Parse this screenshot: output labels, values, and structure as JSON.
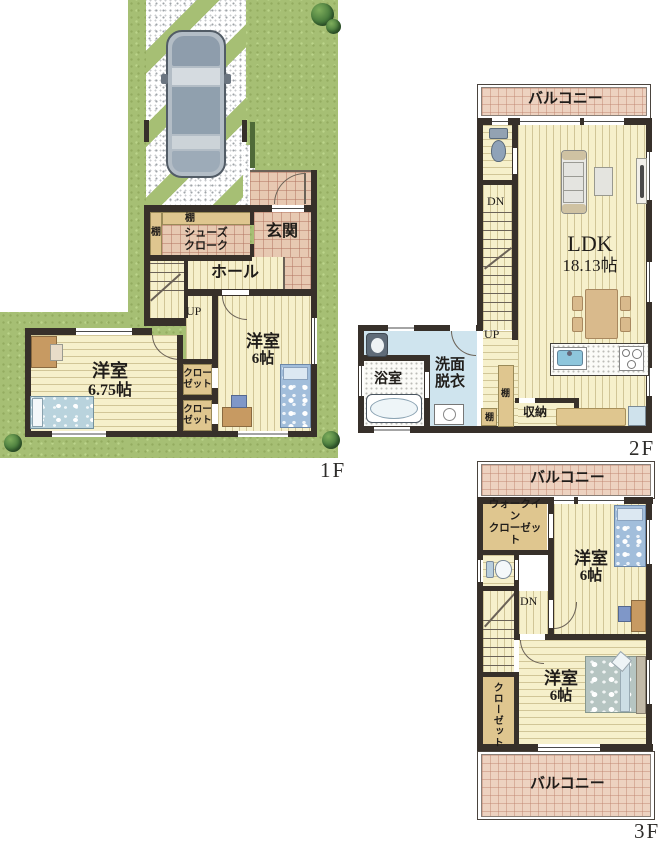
{
  "floors": {
    "f1": {
      "label": "1F",
      "shelf_top": "棚",
      "shelf_left": "棚",
      "shoes_l1": "シューズ",
      "shoes_l2": "クローク",
      "genkan": "玄関",
      "hall": "ホール",
      "up": "UP",
      "room_a_name": "洋室",
      "room_a_size": "6.75帖",
      "room_b_name": "洋室",
      "room_b_size": "6帖",
      "closet_l1": "クロー",
      "closet_l2": "ゼット"
    },
    "f2": {
      "label": "2F",
      "balcony": "バルコニー",
      "dn": "DN",
      "up": "UP",
      "ldk_name": "LDK",
      "ldk_size": "18.13帖",
      "wash_l1": "洗面",
      "wash_l2": "脱衣",
      "bath": "浴室",
      "shelf_a": "棚",
      "shelf_b": "棚",
      "storage": "収納"
    },
    "f3": {
      "label": "3F",
      "balcony_top": "バルコニー",
      "balcony_bottom": "バルコニー",
      "wic_l1": "ウォークイン",
      "wic_l2": "クローゼット",
      "dn": "DN",
      "closet": "クローゼット",
      "room_a_name": "洋室",
      "room_a_size": "6帖",
      "room_b_name": "洋室",
      "room_b_size": "6帖"
    },
    "colors": {
      "grass": "#a6bf74",
      "wood_floor": "#f6f0cb",
      "entry_tile": "#e7c9b2",
      "balcony_tile": "#edd2c0",
      "wall": "#37302a",
      "shelf_tan": "#dfc68f",
      "washroom_floor": "#cfe4ee"
    }
  }
}
